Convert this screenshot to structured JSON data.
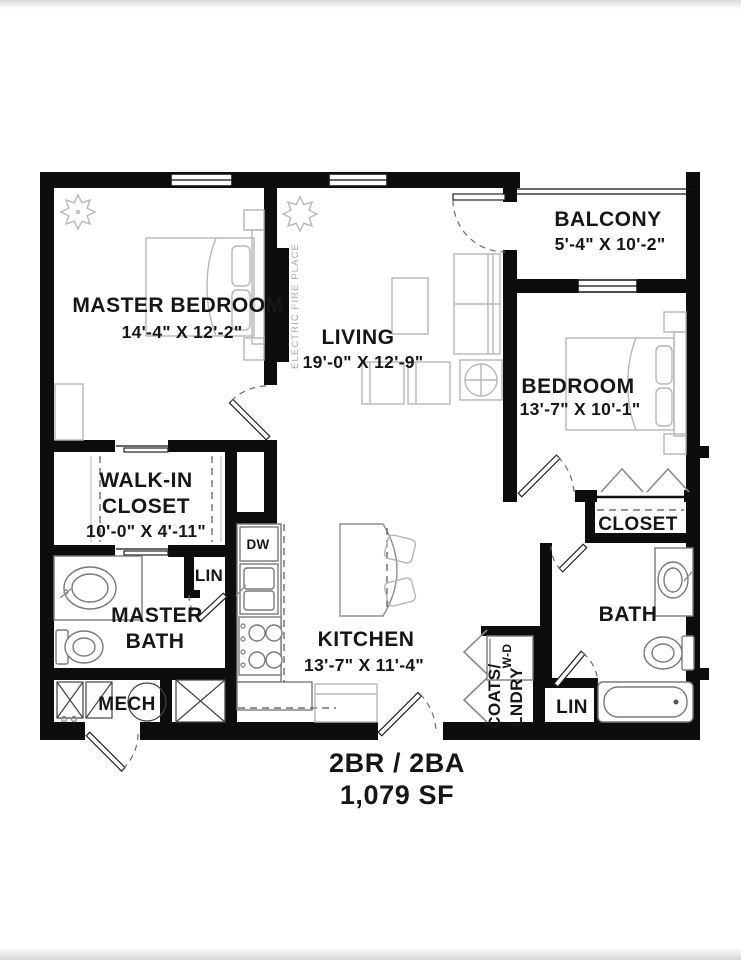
{
  "title_block": {
    "unit_type": "2BR / 2BA",
    "area": "1,079 SF"
  },
  "rooms": {
    "master_bedroom": {
      "name": "MASTER BEDROOM",
      "dims": "14'-4\" X 12'-2\""
    },
    "living": {
      "name": "LIVING",
      "dims": "19'-0\" X 12'-9\""
    },
    "balcony": {
      "name": "BALCONY",
      "dims": "5'-4\" X 10'-2\""
    },
    "bedroom": {
      "name": "BEDROOM",
      "dims": "13'-7\" X 10'-1\""
    },
    "walk_in_closet": {
      "line1": "WALK-IN",
      "line2": "CLOSET",
      "dims": "10'-0\" X 4'-11\""
    },
    "kitchen": {
      "name": "KITCHEN",
      "dims": "13'-7\" X 11'-4\""
    },
    "master_bath": {
      "line1": "MASTER",
      "line2": "BATH"
    },
    "bath": {
      "name": "BATH"
    },
    "mech": {
      "name": "MECH"
    },
    "bedroom_closet": {
      "name": "CLOSET"
    },
    "linen_master": {
      "name": "LIN"
    },
    "linen_hall": {
      "name": "LIN"
    },
    "coats_laundry": {
      "line1": "COATS/",
      "line2": "LNDRY"
    }
  },
  "labels": {
    "dishwasher": "DW",
    "washer_dryer": "W-D",
    "fireplace": "ELECTRIC FIRE PLACE"
  },
  "colors": {
    "wall": "#0d0d0d",
    "text": "#161616",
    "furniture_line": "#b7b7b7",
    "muted_label": "#a8a8a8",
    "background": "#ffffff"
  }
}
